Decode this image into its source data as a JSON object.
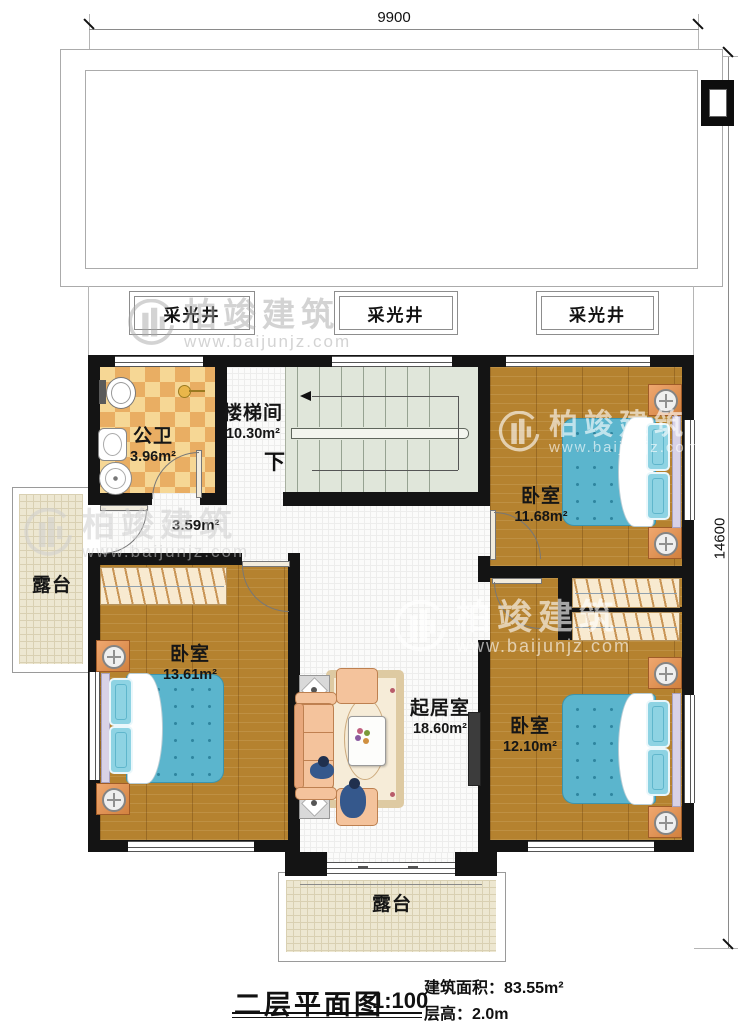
{
  "dimensions": {
    "top": "9900",
    "right": "14600"
  },
  "skylight_label": "采光井",
  "rooms": {
    "stairwell": {
      "name": "楼梯间",
      "area": "10.30m²"
    },
    "bathroom": {
      "name": "公卫",
      "area": "3.96m²"
    },
    "hallway": {
      "area": "3.59m²"
    },
    "bedroom_top_right": {
      "name": "卧室",
      "area": "11.68m²"
    },
    "bedroom_left": {
      "name": "卧室",
      "area": "13.61m²"
    },
    "bedroom_bottom_right": {
      "name": "卧室",
      "area": "12.10m²"
    },
    "living_room": {
      "name": "起居室",
      "area": "18.60m²"
    },
    "terrace_left": {
      "name": "露台"
    },
    "terrace_bottom": {
      "name": "露台"
    },
    "stair_direction": "下"
  },
  "titleblock": {
    "title": "二层平面图",
    "scale": "1:100",
    "building_area_label": "建筑面积：",
    "building_area_value": "83.55m²",
    "floor_height_label": "层高：",
    "floor_height_value": "2.0m"
  },
  "watermark": {
    "brand": "柏竣建筑",
    "url": "www.baijunjz.com"
  }
}
